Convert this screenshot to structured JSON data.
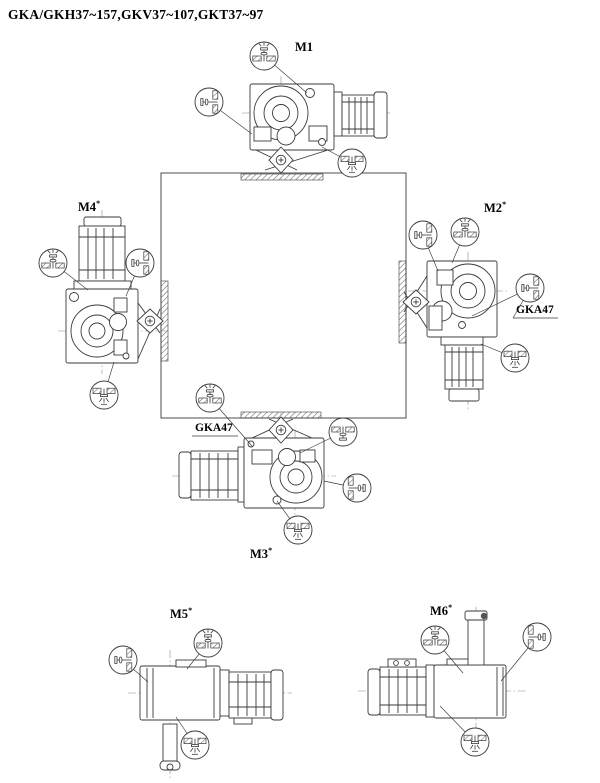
{
  "title": "GKA/GKH37~157,GKV37~107,GKT37~97",
  "colors": {
    "background": "#ffffff",
    "line_art": "#3a3a3a",
    "text": "#000000"
  },
  "mounting_positions": {
    "m1": {
      "label": "M1",
      "mark": ""
    },
    "m2": {
      "label": "M2",
      "mark": "*"
    },
    "m3": {
      "label": "M3",
      "mark": "*"
    },
    "m4": {
      "label": "M4",
      "mark": "*"
    },
    "m5": {
      "label": "M5",
      "mark": "*"
    },
    "m6": {
      "label": "M6",
      "mark": "*"
    }
  },
  "annotations": {
    "gka47_m2": "GKA47",
    "gka47_m3": "GKA47"
  },
  "icons": {
    "vent_plug": "breather-vent-plug-icon",
    "oil_level_plug": "oil-level-plug-icon",
    "oil_fill_plug": "oil-fill-plug-icon",
    "oil_drain_plug": "oil-drain-plug-icon",
    "output_shaft": "output-shaft-diamond-icon"
  }
}
